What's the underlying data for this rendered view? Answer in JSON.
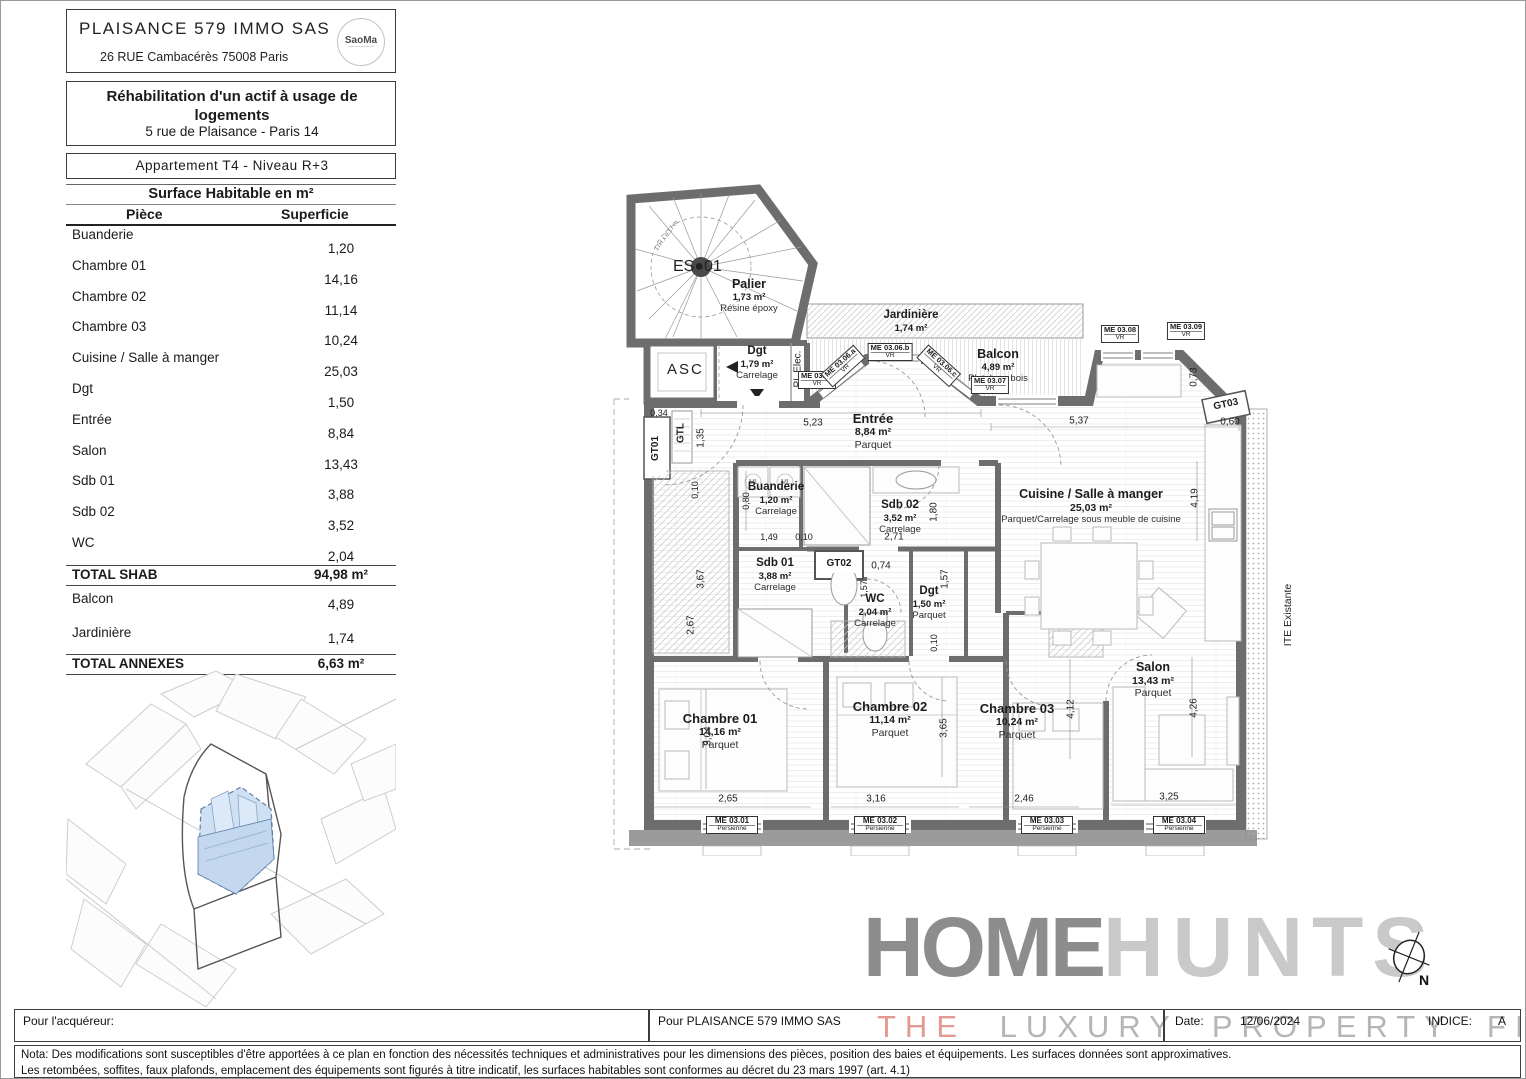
{
  "header": {
    "company": "PLAISANCE 579 IMMO SAS",
    "company_address": "26 RUE Cambacérès 75008 Paris",
    "logo_text": "SaoMa",
    "project_title": "Réhabilitation d'un actif à usage de logements",
    "project_address": "5 rue de Plaisance - Paris 14",
    "apartment_line": "Appartement  T4  -  Niveau R+3"
  },
  "surface_table": {
    "title": "Surface Habitable en m²",
    "col_piece": "Pièce",
    "col_superficie": "Superficie",
    "rows": [
      {
        "label": "Buanderie",
        "value": "1,20"
      },
      {
        "label": "Chambre 01",
        "value": "14,16"
      },
      {
        "label": "Chambre 02",
        "value": "11,14"
      },
      {
        "label": "Chambre 03",
        "value": "10,24"
      },
      {
        "label": "Cuisine / Salle à manger",
        "value": "25,03"
      },
      {
        "label": "Dgt",
        "value": "1,50"
      },
      {
        "label": "Entrée",
        "value": "8,84"
      },
      {
        "label": "Salon",
        "value": "13,43"
      },
      {
        "label": "Sdb 01",
        "value": "3,88"
      },
      {
        "label": "Sdb 02",
        "value": "3,52"
      },
      {
        "label": "WC",
        "value": "2,04"
      }
    ],
    "total_shab_label": "TOTAL SHAB",
    "total_shab_value": "94,98 m²",
    "annex_rows": [
      {
        "label": "Balcon",
        "value": "4,89"
      },
      {
        "label": "Jardinière",
        "value": "1,74"
      }
    ],
    "total_annexes_label": "TOTAL ANNEXES",
    "total_annexes_value": "6,63 m²"
  },
  "plan": {
    "stair_label_left": "ES",
    "stair_label_right": "01",
    "stair_note": "17H x 0,17 m",
    "asc_label": "ASC",
    "palier": {
      "name": "Palier",
      "area": "1,73 m²",
      "floor": "Résine époxy"
    },
    "dgt_common": {
      "name": "Dgt",
      "area": "1,79 m²",
      "floor": "Carrelage"
    },
    "pl_elec": "PL Elec.",
    "gtl": "GTL",
    "ite": "ITE Existante",
    "ml": "ML",
    "jardiniere": {
      "name": "Jardinière",
      "area": "1,74 m²"
    },
    "balcon": {
      "name": "Balcon",
      "area": "4,89 m²",
      "floor": "Platelage bois"
    },
    "rooms": [
      {
        "name": "Entrée",
        "area": "8,84 m²",
        "floor": "Parquet"
      },
      {
        "name": "Buanderie",
        "area": "1,20 m²",
        "floor": "Carrelage"
      },
      {
        "name": "Sdb 02",
        "area": "3,52 m²",
        "floor": "Carrelage"
      },
      {
        "name": "Cuisine / Salle à manger",
        "area": "25,03 m²",
        "floor": "Parquet/Carrelage sous meuble de cuisine"
      },
      {
        "name": "Sdb 01",
        "area": "3,88 m²",
        "floor": "Carrelage"
      },
      {
        "name": "WC",
        "area": "2,04 m²",
        "floor": "Carrelage"
      },
      {
        "name": "Dgt",
        "area": "1,50 m²",
        "floor": "Parquet"
      },
      {
        "name": "Chambre 01",
        "area": "14,16 m²",
        "floor": "Parquet"
      },
      {
        "name": "Chambre 02",
        "area": "11,14 m²",
        "floor": "Parquet"
      },
      {
        "name": "Chambre 03",
        "area": "10,24 m²",
        "floor": "Parquet"
      },
      {
        "name": "Salon",
        "area": "13,43 m²",
        "floor": "Parquet"
      }
    ],
    "gaines": [
      "GT01",
      "GT02",
      "GT03"
    ],
    "windows_top": [
      {
        "code": "ME 03.06",
        "type": "VR"
      },
      {
        "code": "ME 03.06.a",
        "type": "VR"
      },
      {
        "code": "ME 03.06.b",
        "type": "VR"
      },
      {
        "code": "ME 03.06.c",
        "type": "VR"
      },
      {
        "code": "ME 03.07",
        "type": "VR"
      },
      {
        "code": "ME 03.08",
        "type": "VR"
      },
      {
        "code": "ME 03.09",
        "type": "VR"
      }
    ],
    "windows_bottom": [
      {
        "code": "ME 03.01",
        "type": "Persienne"
      },
      {
        "code": "ME 03.02",
        "type": "Persienne"
      },
      {
        "code": "ME 03.03",
        "type": "Persienne"
      },
      {
        "code": "ME 03.04",
        "type": "Persienne"
      }
    ],
    "dims": [
      "5,23",
      "5,37",
      "0,34",
      "1,35",
      "0,73",
      "0,60",
      "4,19",
      "0,10",
      "0,80",
      "1,49",
      "0,10",
      "2,71",
      "1,80",
      "0,74",
      "1,57",
      "1,57",
      "0,10",
      "3,67",
      "2,67",
      "3,04",
      "3,65",
      "4,12",
      "4,26",
      "2,65",
      "3,16",
      "2,46",
      "3,25"
    ],
    "compass": "N"
  },
  "logo": {
    "home": "HOME",
    "hunts": "HUNTS",
    "tagline_the": "THE",
    "tagline_rest": " LUXURY PROPERTY FINDERS"
  },
  "footer": {
    "acquirer_label": "Pour l'acquéreur:",
    "company_label": "Pour PLAISANCE 579 IMMO SAS",
    "date_label": "Date:",
    "date_value": "12/06/2024",
    "indice_label": "INDICE:",
    "indice_value": "A",
    "nota_line1": "Nota: Des modifications sont susceptibles d'être apportées à ce plan en fonction des nécessités techniques et administratives pour les dimensions des pièces, position des baies et équipements. Les surfaces données sont approximatives.",
    "nota_line2": "Les retombées, soffites, faux plafonds, emplacement des équipements sont figurés à titre indicatif, les surfaces habitables sont conformes au décret du 23 mars 1997 (art. 4.1)"
  }
}
